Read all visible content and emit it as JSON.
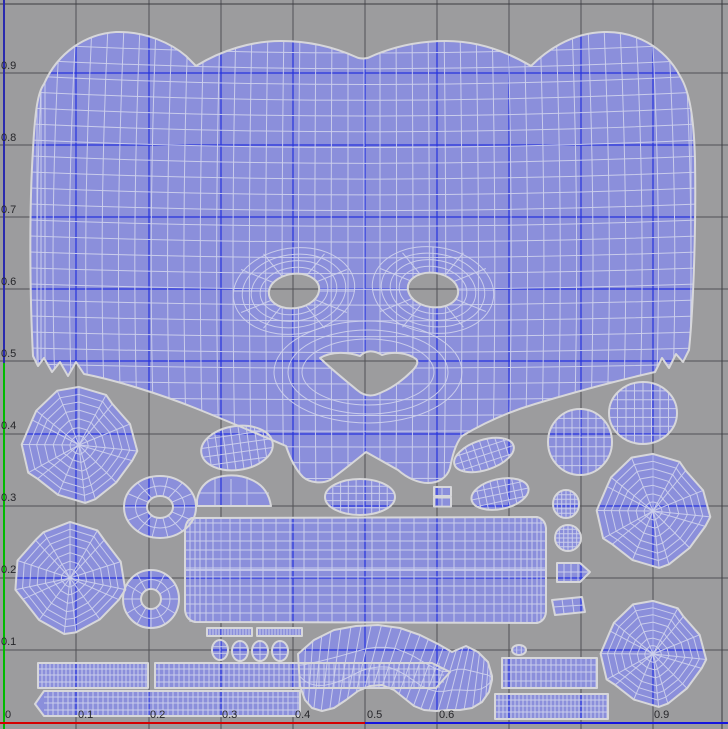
{
  "viewport": {
    "type": "uv-texture-editor",
    "description": "UV editor viewport showing unwrapped character-head UV shells on a 0-1 grid",
    "width": 728,
    "height": 729
  },
  "axis": {
    "left_labels": [
      "0.9",
      "0.8",
      "0.7",
      "0.6",
      "0.5",
      "0.4",
      "0.3",
      "0.2",
      "0.1"
    ],
    "bottom_labels": [
      "0",
      "0.1",
      "0.2",
      "0.3",
      "0.4",
      "0.5",
      "0.6",
      "0.9"
    ]
  },
  "colors": {
    "background": "#9c9c9e",
    "grid": "#515155",
    "unit_border": "#3c3c40",
    "u0_border_navy": "#2a2aae",
    "v0_border_blue": "#1515dd",
    "v_axis_green": "#00bb00",
    "u_axis_red": "#d40000",
    "grid_over_mesh_blue": "#2633dd",
    "island_fill": "#8b8fdb",
    "wireframe": "#ccd0ec",
    "island_outline": "#d7d7da",
    "label": "#26262a"
  },
  "islands": {
    "names": [
      "head-face-shell",
      "left-ear-disc-1",
      "left-ear-disc-2",
      "inner-ear-ring-1",
      "inner-ear-ring-2",
      "ear-back-oval",
      "eyelid-dome",
      "muzzle-oval",
      "tooth-squares",
      "eyelid-bean-1",
      "eyelid-bean-2",
      "eye-ball-egg-1",
      "eye-ball-egg-2",
      "right-ear-disc-1",
      "right-ear-disc-2",
      "paw-pad-oval-1",
      "paw-pad-oval-2",
      "claw-arrow-piece",
      "claw-rhombus-piece",
      "tiny-oval",
      "neck-band-rectangle",
      "lash-strip-1",
      "lash-strip-2",
      "toe-ovals",
      "brow-moustache-band",
      "body-strip-a1",
      "body-strip-a2",
      "body-strip-b1",
      "body-strip-c1",
      "body-strip-c2"
    ]
  }
}
